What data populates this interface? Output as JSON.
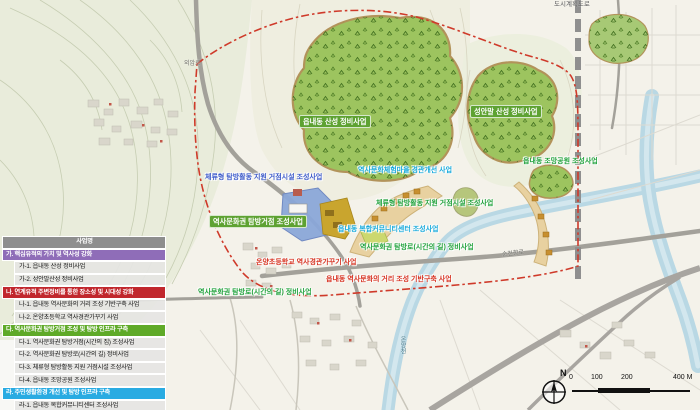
{
  "map": {
    "site_labels": [
      {
        "id": "eupnaedong-sanseong",
        "text": "읍내동 산성 정비사업"
      },
      {
        "id": "seonganmal-sanseong",
        "text": "성안말 산성 정비사업"
      },
      {
        "id": "tambang-geojeom",
        "text": "역사문화권 탐방거점 조성사업"
      },
      {
        "id": "jomang-park",
        "text": "읍내동 조망공원 조성사업"
      },
      {
        "id": "stay-support-green",
        "text": "체류형 탐방활동 지원 거점시설 조성사업"
      },
      {
        "id": "tambang-ro-east",
        "text": "역사문화권 탐방로(시간의 길) 정비사업"
      },
      {
        "id": "tambang-ro-west",
        "text": "역사문화권 탐방로(시간의 길) 정비사업"
      },
      {
        "id": "stay-support-blue",
        "text": "체류형 탐방활동 지원 거점시설 조성사업"
      },
      {
        "id": "experience-village",
        "text": "역사문화체험마을 경관개선 사업"
      },
      {
        "id": "community-center",
        "text": "읍내동 복합커뮤니티센터 조성사업"
      },
      {
        "id": "onyang-school",
        "text": "온양초등학교 역사경관가꾸기 사업"
      },
      {
        "id": "history-street",
        "text": "읍내동 역사문화의 거리 조성 기반구축 사업"
      }
    ],
    "road_labels": {
      "oeamro": "외암로",
      "suncheonhyangro": "순천향로",
      "onyangcheon": "온양천",
      "planned_road": "도시계획도로"
    },
    "compass_north": "N",
    "scale_ticks": [
      "0",
      "100",
      "200",
      "400 M"
    ],
    "colors": {
      "boundary": "#cf3a2a",
      "forest": "#9dc45f",
      "zone_blue": "#8aa6d8",
      "zone_yellow": "#c9a52e",
      "zone_tan": "#e8d1a0",
      "river": "#b9d8e4",
      "label_green": "#1fa13a",
      "label_blue": "#3b59c9",
      "label_cyan": "#15a9db",
      "label_red": "#d6311f"
    }
  },
  "legend": {
    "title": "사업명",
    "groups": [
      {
        "label": "가. 핵심유적의 가치 및 역사성 강화",
        "color": "#8f6db8",
        "items": [
          "가-1. 읍내동 산성 정비사업",
          "가-2. 성안말산성 정비사업"
        ]
      },
      {
        "label": "나. 연계유적 주변정비를 통한 장소성 및 시대성 강화",
        "color": "#c1272d",
        "items": [
          "나-1. 읍내동 역사문화의 거리 조성 기반구축 사업",
          "나-2. 온양초등학교 역사경관가꾸기 사업"
        ]
      },
      {
        "label": "다. 역사문화권 탐방거점 조성 및 탐방 인프라 구축",
        "color": "#5faa28",
        "items": [
          "다-1. 역사문화권 탐방거점(시간의 집) 조성사업",
          "다-2. 역사문화권 탐방로(시간의 길) 정비사업",
          "다-3. 체류형 탐방활동 지원 거점시설 조성사업",
          "다-4. 읍내동 조망공원 조성사업"
        ]
      },
      {
        "label": "라. 주민생활환경 개선 및 탐방 인프라 구축",
        "color": "#29abe2",
        "items": [
          "라-1. 읍내동 복합커뮤니티센터 조성사업",
          "라-2. 역사문화체험마을 경관개선 사업"
        ]
      }
    ]
  }
}
